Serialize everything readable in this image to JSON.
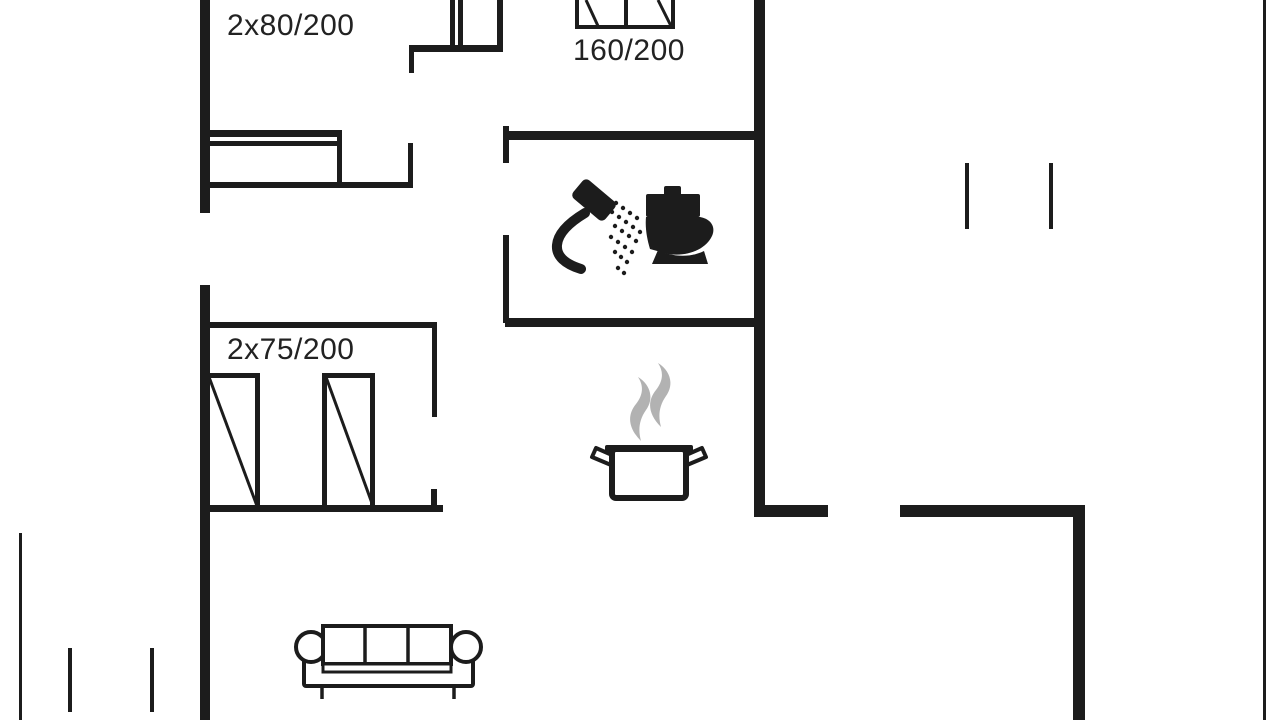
{
  "floorplan": {
    "labels": {
      "double_bed_topleft": "2x80/200",
      "double_bed_center": "160/200",
      "twin_beds": "2x75/200"
    },
    "colors": {
      "line": "#1c1c1c",
      "background": "#ffffff",
      "steam": "#b2b2b2",
      "text": "#222222"
    },
    "icons": {
      "bathroom": [
        "shower-icon",
        "toilet-icon"
      ],
      "kitchen": [
        "cooking-pot-icon",
        "steam-icon"
      ],
      "living_room": [
        "sofa-icon"
      ],
      "bedrooms": [
        "single-bed-icon",
        "double-bed-icon"
      ]
    }
  }
}
